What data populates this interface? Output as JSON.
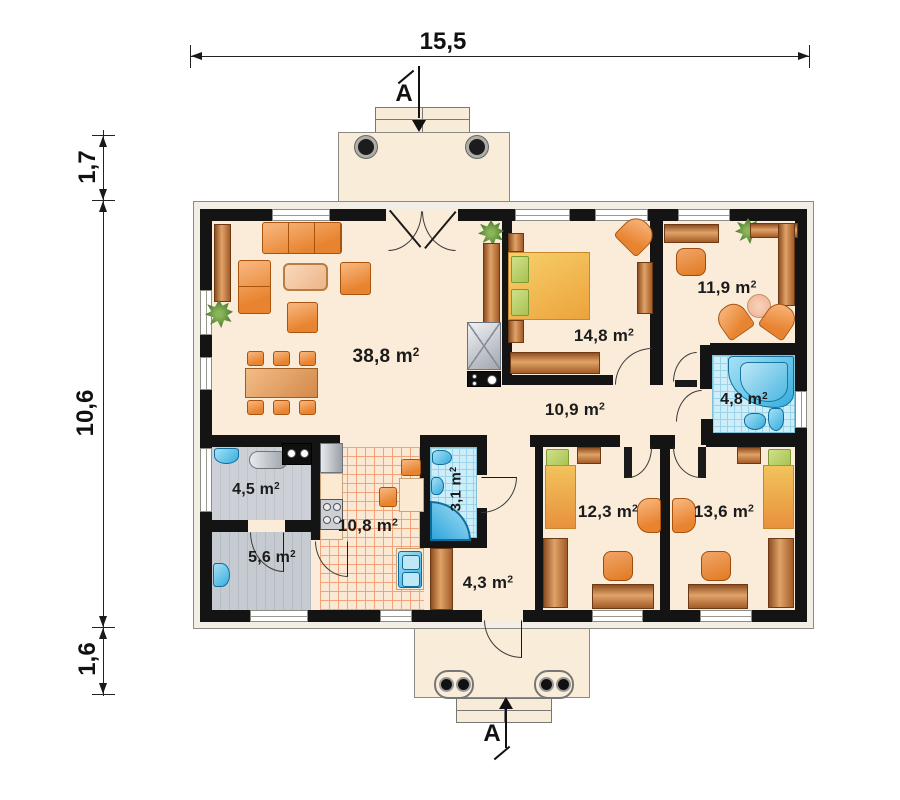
{
  "title": "single-storey house floor plan",
  "dimensions": {
    "top": "15,5",
    "left_upper": "1,7",
    "left_middle": "10,6",
    "left_lower": "1,6"
  },
  "section": {
    "top": "A",
    "bottom": "A"
  },
  "rooms": [
    {
      "id": "living-room",
      "area": "38,8 m",
      "exp": "2"
    },
    {
      "id": "bedroom",
      "area": "14,8 m",
      "exp": "2"
    },
    {
      "id": "office",
      "area": "11,9 m",
      "exp": "2"
    },
    {
      "id": "hall",
      "area": "10,9 m",
      "exp": "2"
    },
    {
      "id": "bathroom",
      "area": "4,8 m",
      "exp": "2"
    },
    {
      "id": "utility",
      "area": "4,5 m",
      "exp": "2"
    },
    {
      "id": "boiler-room",
      "area": "5,6 m",
      "exp": "2"
    },
    {
      "id": "kitchen",
      "area": "10,8 m",
      "exp": "2"
    },
    {
      "id": "wc",
      "area": "3,1 m",
      "exp": "2"
    },
    {
      "id": "rear-hall",
      "area": "4,3 m",
      "exp": "2"
    },
    {
      "id": "kids-room-left",
      "area": "12,3 m",
      "exp": "2"
    },
    {
      "id": "kids-room-right",
      "area": "13,6 m",
      "exp": "2"
    }
  ],
  "colors": {
    "wall": "#141414",
    "floor_cream": "#fbecda",
    "furniture_orange": "#e8832f",
    "wood_brown": "#b5763a",
    "bed_yellow": "#eca33c",
    "pillow_green": "#a9c252",
    "water_blue": "#35aede",
    "tile_blue": "#cdeef8",
    "floor_gray": "#c9cdd3",
    "kitchen_tile_line": "#efa47c"
  }
}
